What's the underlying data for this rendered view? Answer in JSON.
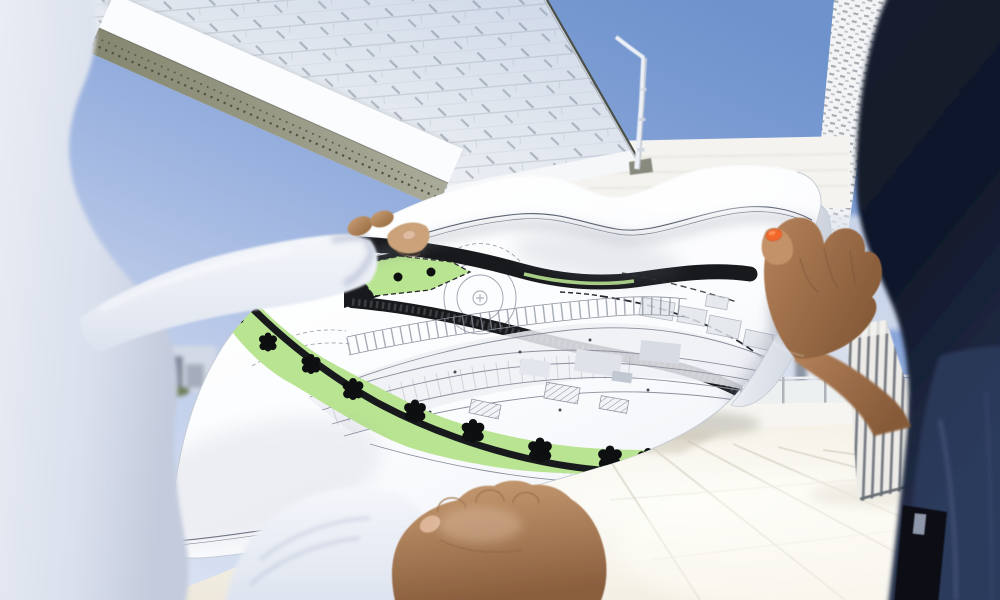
{
  "scene": {
    "kind": "photograph",
    "description": "Two people on a sunny rooftop terrace holding a large unrolled architectural site plan between modern white building volumes",
    "left_person": {
      "clothing": "white long-sleeved shirt",
      "visible_parts": "shoulder and torso (out of focus), extended arm, thumb pressing the sheet, lower fist gripping the bottom edge"
    },
    "right_person": {
      "clothing": "dark navy denim",
      "visible_parts": "shoulder (out of focus), bare forearm, hand gripping the rolled right edge, orange-painted thumbnail"
    },
    "blueprint": {
      "kind": "architectural site / landscape plan",
      "paper": "large white sheet, wavy and curled at the edges",
      "features": [
        "thick black road bands",
        "light green landscape band with black tree symbols",
        "dashed black boundary lines",
        "dense grey building floor-plan linework",
        "concentric circle marking",
        "hatched parcels and grey neighbour blocks",
        "thin double frame line near the sheet edges"
      ],
      "tree_symbol_count": 9,
      "legible_text": "none – line work only"
    },
    "background": [
      "overhanging building volume with white shingle-panel facade",
      "perforated olive soffit band along its underside",
      "white mast / lamp pole",
      "second facade sliver with dashed-panel pattern",
      "white parapet walls and glass railing posts",
      "distant high-rise towers with tree line",
      "bright tiled roof terrace",
      "vertical louvered screen"
    ],
    "lighting": "bright midday sun, clear blue sky with faint clouds"
  },
  "colors": {
    "sky-deep": "#6d92cc",
    "sky-pale": "#e4eaf6",
    "facade-panel": "#f3f4f6",
    "facade-line": "#c9cdd2",
    "soffit-olive": "#90917f",
    "soffit-perf": "#4f5146",
    "edge-dark": "#4c4f45",
    "wall-white": "#f4f3ef",
    "mast-white": "#edf1f7",
    "city-tower": "#46505e",
    "city-trees": "#707d55",
    "parapet": "#f7f6f1",
    "floor-warm": "#ece7da",
    "floor-bright": "#fdfdf9",
    "floor-joint": "#d8d2c4",
    "louver-slat": "#7a7f87",
    "paper-white": "#fbfcfe",
    "paper-shade": "#c9cfdb",
    "frame-line": "#5a6172",
    "plan-line": "#8a909c",
    "plan-fill": "#eef0f4",
    "band-black": "#17191c",
    "plan-green": "#b9e491",
    "tree-black": "#0e0f10",
    "shirt-light": "#e9edf5",
    "shirt-shadow": "#bfc8da",
    "skin-light": "#c69c74",
    "skin-mid": "#b5825a",
    "skin-deep": "#8a5f3e",
    "nail-neutral": "#dfbca1",
    "nail-orange": "#f2682c",
    "navy-dark": "#151d2e",
    "navy-mid": "#27334f",
    "denim-light": "#2e3c5e",
    "seam": "#5a6a92"
  }
}
